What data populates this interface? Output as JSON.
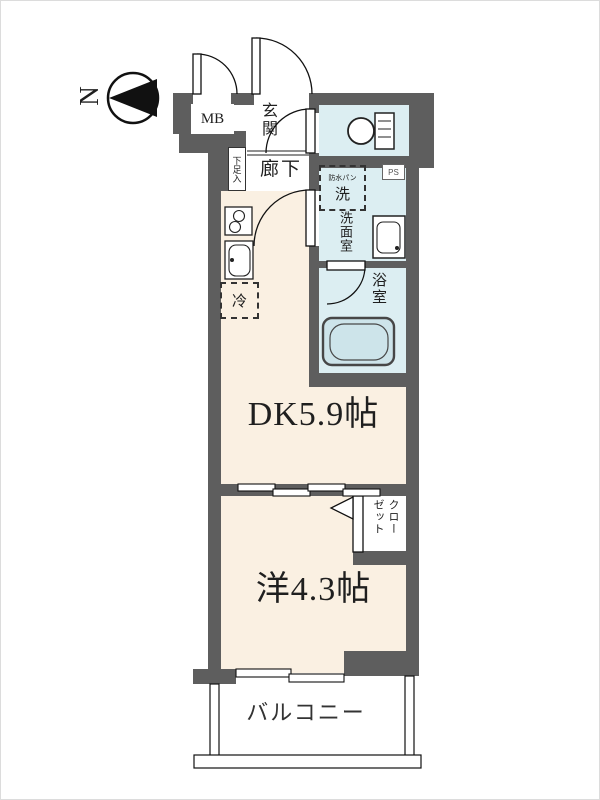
{
  "compass": {
    "north": "N"
  },
  "labels": {
    "meter_box": "MB",
    "entrance": "玄関",
    "shoe_cabinet": "下足入",
    "hallway": "廊下",
    "washer_pan": "防水パン",
    "washer": "洗",
    "pipe_space": "PS",
    "washroom": "洗面室",
    "bathroom": "浴室",
    "refrigerator": "冷",
    "dining_kitchen": "DK5.9帖",
    "closet_col_right": "クロー",
    "closet_col_left": "ゼット",
    "western_room": "洋4.3帖",
    "balcony": "バルコニー"
  },
  "colors": {
    "wall": "#5e5e5e",
    "room_floor": "#faf0e2",
    "wet_area": "#dceef2",
    "bathtub": "#cde4ea",
    "line": "#1f1f1f"
  }
}
